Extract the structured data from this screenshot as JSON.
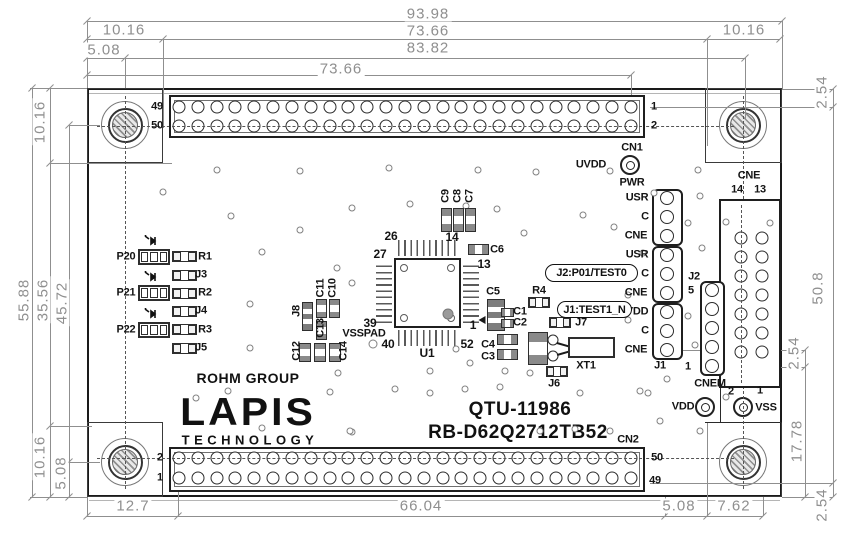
{
  "logo": {
    "rohm": "ROHM GROUP",
    "lapis": "LAPIS",
    "tech": "TECHNOLOGY"
  },
  "ids": {
    "part": "QTU-11986",
    "model": "RB-D62Q2712TB52"
  },
  "callouts": {
    "j2": "J2:P01/TEST0",
    "j1": "J1:TEST1_N"
  },
  "dim_labels": [
    {
      "t": "93.98",
      "x": 428,
      "y": 14
    },
    {
      "t": "10.16",
      "x": 124,
      "y": 30
    },
    {
      "t": "73.66",
      "x": 428,
      "y": 31
    },
    {
      "t": "10.16",
      "x": 744,
      "y": 30
    },
    {
      "t": "5.08",
      "x": 104,
      "y": 50
    },
    {
      "t": "83.82",
      "x": 428,
      "y": 48
    },
    {
      "t": "73.66",
      "x": 341,
      "y": 69
    },
    {
      "t": "10.16",
      "x": 40,
      "y": 122,
      "r": 1
    },
    {
      "t": "55.88",
      "x": 24,
      "y": 300,
      "r": 1
    },
    {
      "t": "35.56",
      "x": 43,
      "y": 300,
      "r": 1
    },
    {
      "t": "45.72",
      "x": 62,
      "y": 303,
      "r": 1
    },
    {
      "t": "10.16",
      "x": 40,
      "y": 457,
      "r": 1
    },
    {
      "t": "5.08",
      "x": 61,
      "y": 473,
      "r": 1
    },
    {
      "t": "12.7",
      "x": 133,
      "y": 506
    },
    {
      "t": "66.04",
      "x": 421,
      "y": 506
    },
    {
      "t": "5.08",
      "x": 679,
      "y": 506
    },
    {
      "t": "7.62",
      "x": 734,
      "y": 506
    },
    {
      "t": "2.54",
      "x": 822,
      "y": 92,
      "r": 1
    },
    {
      "t": "50.8",
      "x": 818,
      "y": 288,
      "r": 1
    },
    {
      "t": "2.54",
      "x": 794,
      "y": 353,
      "r": 1
    },
    {
      "t": "17.78",
      "x": 797,
      "y": 441,
      "r": 1
    },
    {
      "t": "2.54",
      "x": 822,
      "y": 505,
      "r": 1
    }
  ],
  "silk_labels": [
    {
      "t": "49",
      "x": 157,
      "y": 107
    },
    {
      "t": "50",
      "x": 157,
      "y": 126
    },
    {
      "t": "1",
      "x": 654,
      "y": 107
    },
    {
      "t": "2",
      "x": 654,
      "y": 126
    },
    {
      "t": "CN1",
      "x": 632,
      "y": 148
    },
    {
      "t": "2",
      "x": 160,
      "y": 458
    },
    {
      "t": "1",
      "x": 160,
      "y": 478
    },
    {
      "t": "50",
      "x": 657,
      "y": 458
    },
    {
      "t": "49",
      "x": 655,
      "y": 481
    },
    {
      "t": "CN2",
      "x": 628,
      "y": 440
    },
    {
      "t": "UVDD",
      "x": 591,
      "y": 165
    },
    {
      "t": "PWR",
      "x": 632,
      "y": 183
    },
    {
      "t": "USR",
      "x": 637,
      "y": 198
    },
    {
      "t": "C",
      "x": 645,
      "y": 217
    },
    {
      "t": "CNE",
      "x": 636,
      "y": 236
    },
    {
      "t": "USR",
      "x": 637,
      "y": 255
    },
    {
      "t": "C",
      "x": 645,
      "y": 274
    },
    {
      "t": "CNE",
      "x": 636,
      "y": 293
    },
    {
      "t": "VDD",
      "x": 637,
      "y": 312
    },
    {
      "t": "C",
      "x": 645,
      "y": 331
    },
    {
      "t": "CNE",
      "x": 636,
      "y": 350
    },
    {
      "t": "J2",
      "x": 694,
      "y": 277
    },
    {
      "t": "J1",
      "x": 660,
      "y": 366
    },
    {
      "t": "5",
      "x": 691,
      "y": 291
    },
    {
      "t": "1",
      "x": 688,
      "y": 367
    },
    {
      "t": "CNEM",
      "x": 710,
      "y": 384
    },
    {
      "t": "CNE",
      "x": 749,
      "y": 176
    },
    {
      "t": "14",
      "x": 737,
      "y": 190
    },
    {
      "t": "13",
      "x": 760,
      "y": 190
    },
    {
      "t": "VDD",
      "x": 683,
      "y": 407
    },
    {
      "t": "VSS",
      "x": 766,
      "y": 408
    },
    {
      "t": "2",
      "x": 731,
      "y": 392
    },
    {
      "t": "1",
      "x": 760,
      "y": 391
    },
    {
      "t": "P20",
      "x": 126,
      "y": 257
    },
    {
      "t": "P21",
      "x": 126,
      "y": 293
    },
    {
      "t": "P22",
      "x": 126,
      "y": 330
    },
    {
      "t": "R1",
      "x": 205,
      "y": 257
    },
    {
      "t": "J3",
      "x": 201,
      "y": 275
    },
    {
      "t": "R2",
      "x": 205,
      "y": 293
    },
    {
      "t": "J4",
      "x": 201,
      "y": 311
    },
    {
      "t": "R3",
      "x": 205,
      "y": 330
    },
    {
      "t": "J5",
      "x": 201,
      "y": 348
    },
    {
      "t": "26",
      "x": 391,
      "y": 236,
      "s": 12
    },
    {
      "t": "14",
      "x": 452,
      "y": 237,
      "s": 12
    },
    {
      "t": "27",
      "x": 380,
      "y": 254,
      "s": 12
    },
    {
      "t": "13",
      "x": 484,
      "y": 264,
      "s": 12
    },
    {
      "t": "39",
      "x": 370,
      "y": 323,
      "s": 12
    },
    {
      "t": "1",
      "x": 473,
      "y": 325,
      "s": 12
    },
    {
      "t": "40",
      "x": 388,
      "y": 344,
      "s": 12
    },
    {
      "t": "52",
      "x": 467,
      "y": 344,
      "s": 12
    },
    {
      "t": "U1",
      "x": 427,
      "y": 353,
      "s": 12
    },
    {
      "t": "VSSPAD",
      "x": 364,
      "y": 334
    },
    {
      "t": "C9",
      "x": 446,
      "y": 196,
      "r": 1
    },
    {
      "t": "C8",
      "x": 458,
      "y": 196,
      "r": 1
    },
    {
      "t": "C7",
      "x": 470,
      "y": 196,
      "r": 1
    },
    {
      "t": "C6",
      "x": 497,
      "y": 250
    },
    {
      "t": "C11",
      "x": 321,
      "y": 288,
      "r": 1
    },
    {
      "t": "C10",
      "x": 333,
      "y": 288,
      "r": 1
    },
    {
      "t": "J8",
      "x": 297,
      "y": 311,
      "r": 1
    },
    {
      "t": "C13",
      "x": 321,
      "y": 328,
      "r": 1
    },
    {
      "t": "C12",
      "x": 297,
      "y": 351,
      "r": 1
    },
    {
      "t": "C14",
      "x": 344,
      "y": 351,
      "r": 1
    },
    {
      "t": "C5",
      "x": 493,
      "y": 292
    },
    {
      "t": "C1",
      "x": 520,
      "y": 312
    },
    {
      "t": "C2",
      "x": 520,
      "y": 323
    },
    {
      "t": "C4",
      "x": 488,
      "y": 345
    },
    {
      "t": "C3",
      "x": 488,
      "y": 357
    },
    {
      "t": "R4",
      "x": 539,
      "y": 291
    },
    {
      "t": "J7",
      "x": 581,
      "y": 323
    },
    {
      "t": "XT1",
      "x": 586,
      "y": 366
    },
    {
      "t": "J6",
      "x": 554,
      "y": 384
    }
  ]
}
